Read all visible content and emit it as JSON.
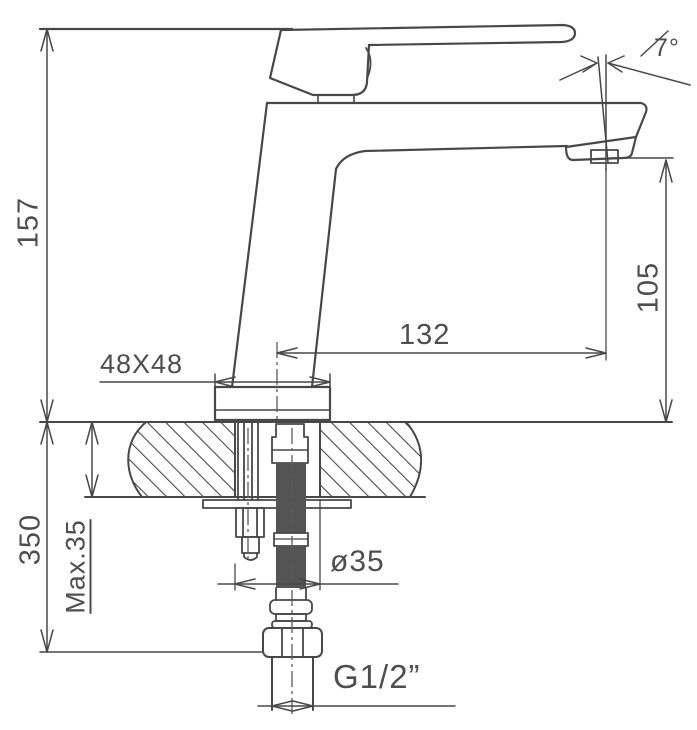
{
  "drawing": {
    "type": "technical-installation-drawing",
    "subject": "single-lever basin faucet side elevation with countertop cross-section",
    "line_color": "#484848",
    "text_color": "#4e4e4e",
    "labels": {
      "total_height": "157",
      "hose_length_below": "350",
      "max_counter_thickness": "Max.35",
      "base_footprint": "48X48",
      "spout_reach": "132",
      "spout_height": "105",
      "spout_angle": "7°",
      "mounting_hole_diameter": "ø35",
      "inlet_thread": "G1/2”"
    }
  }
}
